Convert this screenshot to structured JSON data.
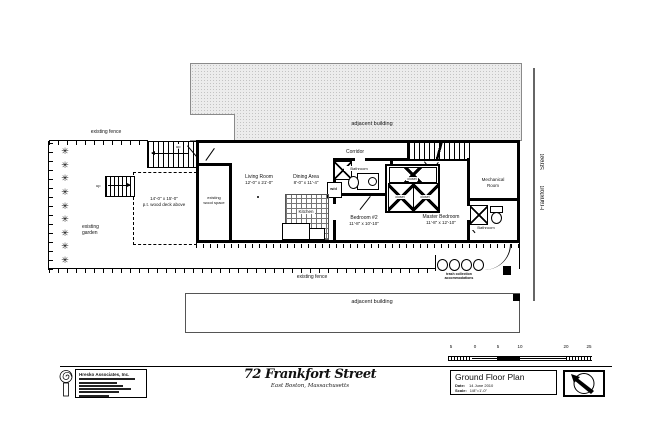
{
  "site": {
    "adjacent_building_top": "adjacent building",
    "adjacent_building_bottom": "adjacent building",
    "street_line1": "Frankfort",
    "street_line2": "Street",
    "fence_top_label": "existing fence",
    "fence_bottom_label": "existing fence",
    "garden_line1": "existing",
    "garden_line2": "garden",
    "deck_dims": "14'-0\" x 15'-0\"",
    "deck_name": "p.t. wood deck above",
    "wood_space_line1": "existing",
    "wood_space_line2": "wood space",
    "trash_line1": "trash collection",
    "trash_line2": "accommodations",
    "up_label": "up",
    "plant_icon": "✳"
  },
  "rooms": {
    "corridor": "Corridor",
    "living_name": "Living Room",
    "living_dims": "12'-0\" x 21'-0\"",
    "dining_name": "Dining Area",
    "dining_dims": "8'-0\" x 11'-4\"",
    "kitchen": "Kitchen",
    "bathroom_center": "Bathroom",
    "bathroom_right": "Bathroom",
    "bedroom2_name": "Bedroom #2",
    "bedroom2_dims": "11'-8\" x 10'-10\"",
    "master_name": "Master Bedroom",
    "master_dims": "11'-8\" x 12'-10\"",
    "mechanical_line1": "Mechanical",
    "mechanical_line2": "Room",
    "closet": "closet",
    "washer_dryer": "w/d"
  },
  "scalebar": {
    "ticks": [
      "5",
      "0",
      "5",
      "10",
      "20",
      "25"
    ]
  },
  "titleblock": {
    "firm_name": "Hresko Associates, Inc.",
    "project_title": "72 Frankfort Street",
    "project_subtitle": "East Boston, Massachusetts",
    "sheet_title": "Ground Floor Plan",
    "date_label": "Date:",
    "date_value": "14 June 2010",
    "scale_label": "Scale:",
    "scale_value": "1/8\"=1'-0\""
  }
}
